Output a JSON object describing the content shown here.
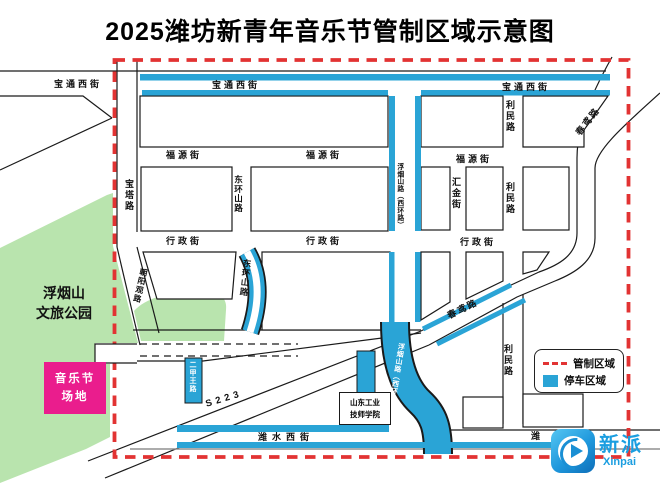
{
  "title": "2025潍坊新青年音乐节管制区域示意图",
  "streets": {
    "baotong_xi": "宝通西街",
    "fuyuan": "福源街",
    "xingzheng": "行政街",
    "limin": "利民路",
    "chunyuan": "春鸢路",
    "donghuanshan": "东环山路",
    "fuyanshan_xihuan": "浮烟山路（西环路）",
    "huijin": "汇金街",
    "baota": "宝塔路",
    "chaoyangguan": "朝阳观路",
    "erjiawang": "二甲王路",
    "s223": "S223",
    "weishui_xi": "潍水西街",
    "wei_partial": "潍"
  },
  "areas": {
    "park_line1": "浮烟山",
    "park_line2": "文旅公园",
    "venue_line1": "音乐节",
    "venue_line2": "场地",
    "school_line1": "山东工业",
    "school_line2": "技师学院"
  },
  "legend": {
    "control_area": "管制区域",
    "parking_area": "停车区域"
  },
  "logo": {
    "cn": "新派",
    "en": "Xinpai"
  },
  "colors": {
    "control_red": "#e23333",
    "parking_blue": "#2aa4d6",
    "park_green": "#b9e4ae",
    "venue_pink": "#ea1d8d",
    "logo_blue": "#1b9ee0"
  }
}
